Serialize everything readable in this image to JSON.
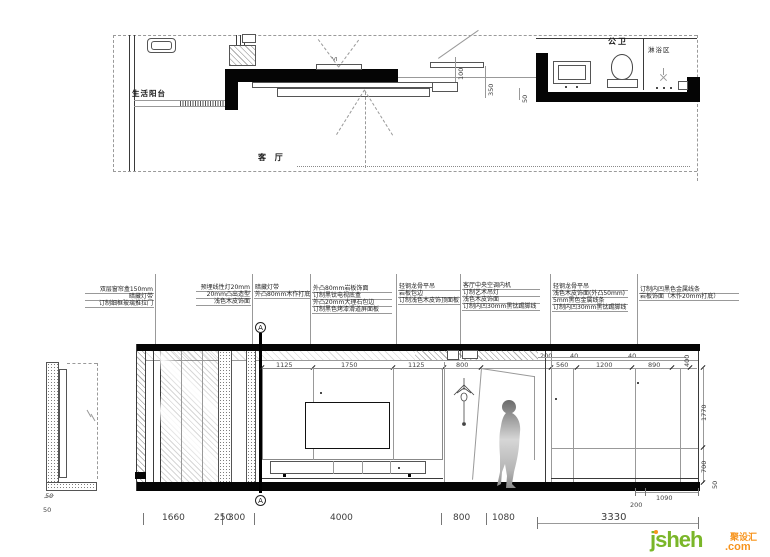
{
  "plan": {
    "room_balcony": "生活阳台",
    "room_living": "客 厅",
    "room_bath": "公卫",
    "room_shower": "淋浴区",
    "view_marker": "VI",
    "dim_100": "100",
    "dim_350": "350",
    "dim_50": "50"
  },
  "notes": {
    "col1": [
      "双层窗帘盒150mm",
      "暗藏灯带",
      "订制细框玻璃推拉门"
    ],
    "col2": [
      "预埋线性灯20mm",
      "20mm凸出造型",
      "浅色木皮饰面"
    ],
    "col3": [
      "暗藏灯带",
      "外凸80mm木作打底"
    ],
    "col4": [
      "外凸80mm岩板饰面",
      "订制黑钛电视底盒",
      "外凸20mm大理石包边",
      "订制黑色烤漆滑道屏面板"
    ],
    "col5": [
      "轻钢龙骨平吊",
      "岩板包边",
      "订制浅色木皮饰顶面板"
    ],
    "col6": [
      "客厅中央空调内机",
      "订制艺术吊灯",
      "浅色木皮饰面",
      "订制内凹30mm黑钛踢脚线"
    ],
    "col7": [
      "轻钢龙骨平吊",
      "浅色木皮饰面(外凸50mm)",
      "5mm黑色金属线条",
      "订制内凹30mm黑钛踢脚线"
    ],
    "col8": [
      "订制内凹黑色金属线条",
      "岩板饰面（木作20mm打底）"
    ]
  },
  "elevation": {
    "section_marker": "A",
    "dims_panel": [
      "1125",
      "1750",
      "1125",
      "800"
    ],
    "dims_ceiling_right": [
      "200",
      "40",
      "40",
      "400"
    ],
    "dims_wall_right": [
      "560",
      "1200",
      "890"
    ],
    "dim_1770": "1770",
    "dim_700": "700",
    "dim_50_right": "50",
    "dim_sub_200": "200",
    "dim_sub_1090": "1090",
    "detail_dim_50a": "50",
    "detail_dim_50b": "50",
    "dims_bottom": [
      "1660",
      "250",
      "300",
      "4000",
      "800",
      "1080"
    ],
    "dim_total_3330": "3330"
  },
  "logo": {
    "name": "jsheh",
    "tld": ".com",
    "brand_cn": "聚设汇"
  }
}
